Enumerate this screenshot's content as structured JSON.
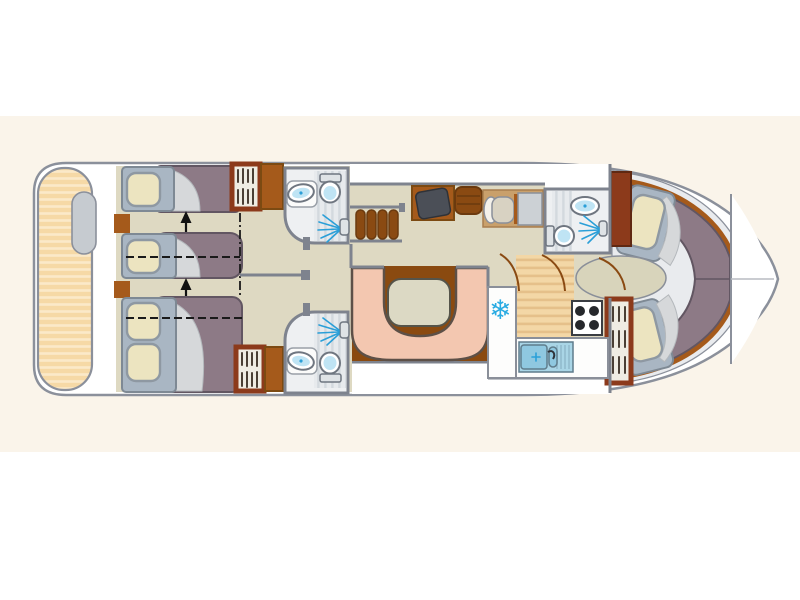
{
  "title": "houseboat-deck-plan",
  "palette": {
    "paper": "#faf4ea",
    "outline": "#8b909b",
    "hull": "#ffffff",
    "walkway": "#e9ebee",
    "wall": "#7e838e",
    "deck": "#f6d9a6",
    "deckLine": "#fbe9c9",
    "floor": "#ded9c2",
    "floorOval": "#d8d4bb",
    "brown": "#a55a1b",
    "brownDark": "#7c4a12",
    "wardrobeFrame": "#8c3a1b",
    "wardrobeFill": "#efece3",
    "mattress": "#8d7a86",
    "mattressEdge": "#625662",
    "headboard": "#a9b6c3",
    "pillow": "#ece4c0",
    "bathFloor": "#eef0f2",
    "bathStripe": "#d3d9de",
    "fixtureBlue": "#bfe4f4",
    "accentBlue": "#2a9fd8",
    "bench": "#f3c7b0",
    "benchEdge": "#5d5047",
    "table": "#dcd9c4",
    "saloonFloor": "#8a4a10",
    "mat": "#c9a06b",
    "steel": "#ccd1d5",
    "screen": "#4b4f57",
    "stepTan": "#f3d7a6",
    "stepTanLine": "#e5c08a",
    "snow": "#29abe2",
    "sink": "#a9d5e6",
    "sinkBasin": "#8fc8e0",
    "burner": "#26282c"
  },
  "icons": {
    "snowflake": "❄"
  }
}
